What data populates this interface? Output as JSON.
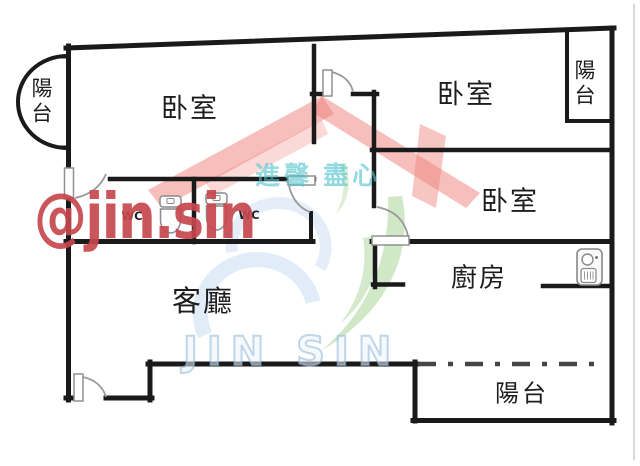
{
  "rooms": {
    "bedroom1": "卧室",
    "bedroom2": "卧室",
    "bedroom3": "卧室",
    "living_room": "客廳",
    "kitchen": "廚房",
    "balcony_left": "陽台",
    "balcony_top_right": "陽台",
    "balcony_bottom": "陽台",
    "wc1": "WC",
    "wc2": "WC"
  },
  "watermarks": {
    "handle": "@jin.sin",
    "brand_cjk": "進馨 盡心",
    "brand_latin": "JIN SIN"
  },
  "colors": {
    "wall": "#1a1a1a",
    "door": "#979797",
    "fixture": "#8a8a8a",
    "dash_line": "#454545",
    "watermark_red_text": "#c6484e",
    "watermark_roof_red": "#ed807a",
    "watermark_leaf_green": "#91c878",
    "watermark_swoosh_blue": "#a0c3e6",
    "watermark_teal": "#50c3cd"
  },
  "icons": {
    "toilet1": "toilet-icon",
    "toilet2": "toilet-icon",
    "water_heater": "water-heater-icon",
    "balcony_arc": "curved-balcony-wall",
    "dash_line": "balcony-boundary-dashdot-line"
  }
}
